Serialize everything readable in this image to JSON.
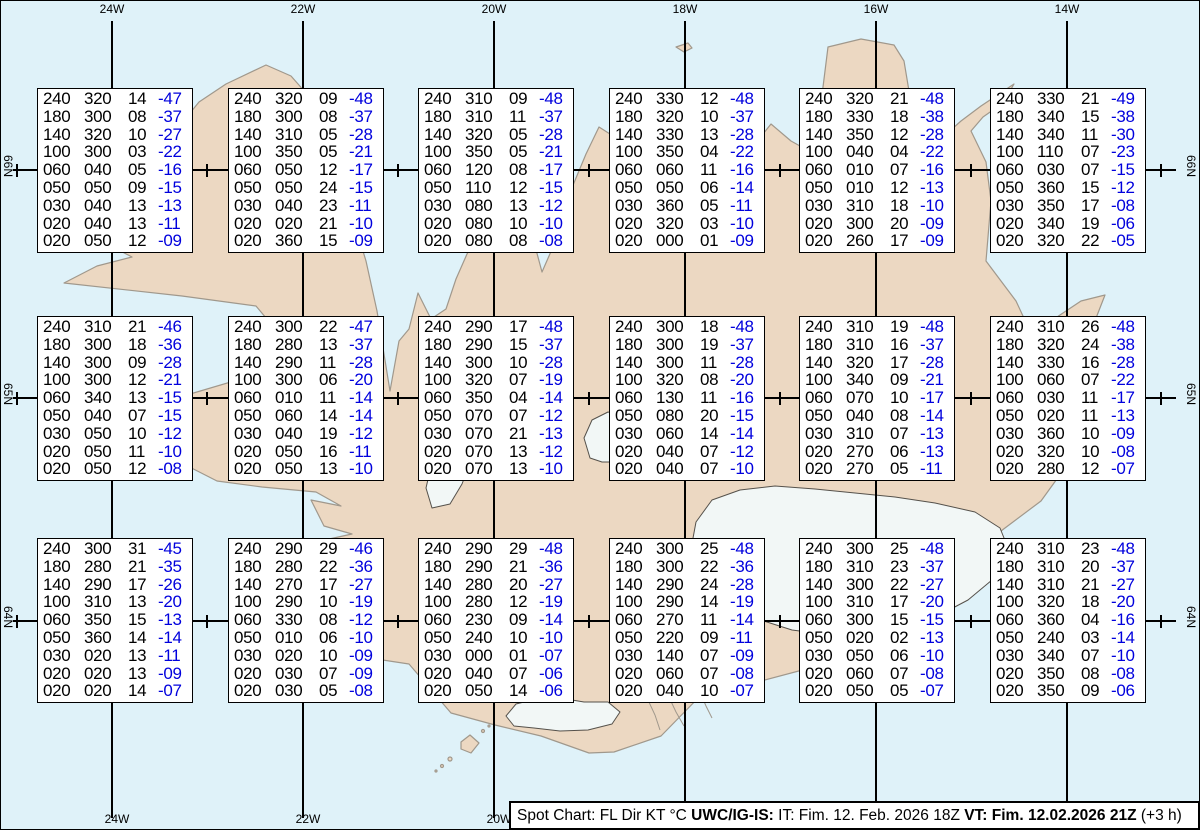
{
  "colors": {
    "ocean": "#dff2f9",
    "land": "#ecd8c2",
    "coast": "#a0988c",
    "glacier": "#f2f7f6",
    "glacier_outline": "#55514b",
    "graticule": "#000000",
    "box_bg": "#ffffff",
    "box_border": "#000000",
    "text_black": "#000000",
    "temp_blue": "#0000dd",
    "footer_bg": "#ffffff"
  },
  "graticule": {
    "meridians": [
      {
        "label": "24W",
        "x": 112
      },
      {
        "label": "22W",
        "x": 303
      },
      {
        "label": "20W",
        "x": 494
      },
      {
        "label": "18W",
        "x": 685
      },
      {
        "label": "16W",
        "x": 876
      },
      {
        "label": "14W",
        "x": 1067
      }
    ],
    "parallels": [
      {
        "label": "66N",
        "y": 170
      },
      {
        "label": "65N",
        "y": 398
      },
      {
        "label": "64N",
        "y": 621
      }
    ],
    "tick_xs": [
      17,
      207,
      398,
      589,
      780,
      971,
      1161
    ]
  },
  "spot_grid": {
    "col_x": [
      37,
      228,
      418,
      609,
      799,
      990
    ],
    "row_y": [
      88,
      316,
      538
    ],
    "box_w": 156,
    "box_h": 165,
    "column_meaning": [
      "FL",
      "Dir",
      "KT",
      "C"
    ]
  },
  "boxes": [
    {
      "id": "r1c1",
      "row": 0,
      "col": 0,
      "rows": [
        [
          "240",
          "320",
          "14",
          "-47"
        ],
        [
          "180",
          "300",
          "08",
          "-37"
        ],
        [
          "140",
          "320",
          "10",
          "-27"
        ],
        [
          "100",
          "300",
          "03",
          "-22"
        ],
        [
          "060",
          "040",
          "05",
          "-16"
        ],
        [
          "050",
          "050",
          "09",
          "-15"
        ],
        [
          "030",
          "040",
          "13",
          "-13"
        ],
        [
          "020",
          "040",
          "13",
          "-11"
        ],
        [
          "020",
          "050",
          "12",
          "-09"
        ]
      ]
    },
    {
      "id": "r1c2",
      "row": 0,
      "col": 1,
      "rows": [
        [
          "240",
          "320",
          "09",
          "-48"
        ],
        [
          "180",
          "300",
          "08",
          "-37"
        ],
        [
          "140",
          "310",
          "05",
          "-28"
        ],
        [
          "100",
          "350",
          "05",
          "-21"
        ],
        [
          "060",
          "050",
          "12",
          "-17"
        ],
        [
          "050",
          "050",
          "24",
          "-15"
        ],
        [
          "030",
          "040",
          "23",
          "-11"
        ],
        [
          "020",
          "020",
          "21",
          "-10"
        ],
        [
          "020",
          "360",
          "15",
          "-09"
        ]
      ]
    },
    {
      "id": "r1c3",
      "row": 0,
      "col": 2,
      "rows": [
        [
          "240",
          "310",
          "09",
          "-48"
        ],
        [
          "180",
          "310",
          "11",
          "-37"
        ],
        [
          "140",
          "320",
          "05",
          "-28"
        ],
        [
          "100",
          "350",
          "05",
          "-21"
        ],
        [
          "060",
          "120",
          "08",
          "-17"
        ],
        [
          "050",
          "110",
          "12",
          "-15"
        ],
        [
          "030",
          "080",
          "13",
          "-12"
        ],
        [
          "020",
          "080",
          "10",
          "-10"
        ],
        [
          "020",
          "080",
          "08",
          "-08"
        ]
      ]
    },
    {
      "id": "r1c4",
      "row": 0,
      "col": 3,
      "rows": [
        [
          "240",
          "330",
          "12",
          "-48"
        ],
        [
          "180",
          "320",
          "10",
          "-37"
        ],
        [
          "140",
          "330",
          "13",
          "-28"
        ],
        [
          "100",
          "350",
          "04",
          "-22"
        ],
        [
          "060",
          "060",
          "11",
          "-16"
        ],
        [
          "050",
          "050",
          "06",
          "-14"
        ],
        [
          "030",
          "360",
          "05",
          "-11"
        ],
        [
          "020",
          "320",
          "03",
          "-10"
        ],
        [
          "020",
          "000",
          "01",
          "-09"
        ]
      ]
    },
    {
      "id": "r1c5",
      "row": 0,
      "col": 4,
      "rows": [
        [
          "240",
          "320",
          "21",
          "-48"
        ],
        [
          "180",
          "330",
          "18",
          "-38"
        ],
        [
          "140",
          "350",
          "12",
          "-28"
        ],
        [
          "100",
          "040",
          "04",
          "-22"
        ],
        [
          "060",
          "010",
          "07",
          "-16"
        ],
        [
          "050",
          "010",
          "12",
          "-13"
        ],
        [
          "030",
          "310",
          "18",
          "-10"
        ],
        [
          "020",
          "300",
          "20",
          "-09"
        ],
        [
          "020",
          "260",
          "17",
          "-09"
        ]
      ]
    },
    {
      "id": "r1c6",
      "row": 0,
      "col": 5,
      "rows": [
        [
          "240",
          "330",
          "21",
          "-49"
        ],
        [
          "180",
          "340",
          "15",
          "-38"
        ],
        [
          "140",
          "340",
          "11",
          "-30"
        ],
        [
          "100",
          "110",
          "07",
          "-23"
        ],
        [
          "060",
          "030",
          "07",
          "-15"
        ],
        [
          "050",
          "360",
          "15",
          "-12"
        ],
        [
          "030",
          "350",
          "17",
          "-08"
        ],
        [
          "020",
          "340",
          "19",
          "-06"
        ],
        [
          "020",
          "320",
          "22",
          "-05"
        ]
      ]
    },
    {
      "id": "r2c1",
      "row": 1,
      "col": 0,
      "rows": [
        [
          "240",
          "310",
          "21",
          "-46"
        ],
        [
          "180",
          "300",
          "18",
          "-36"
        ],
        [
          "140",
          "300",
          "09",
          "-28"
        ],
        [
          "100",
          "300",
          "12",
          "-21"
        ],
        [
          "060",
          "340",
          "13",
          "-15"
        ],
        [
          "050",
          "040",
          "07",
          "-15"
        ],
        [
          "030",
          "050",
          "10",
          "-12"
        ],
        [
          "020",
          "050",
          "11",
          "-10"
        ],
        [
          "020",
          "050",
          "12",
          "-08"
        ]
      ]
    },
    {
      "id": "r2c2",
      "row": 1,
      "col": 1,
      "rows": [
        [
          "240",
          "300",
          "22",
          "-47"
        ],
        [
          "180",
          "280",
          "13",
          "-37"
        ],
        [
          "140",
          "290",
          "11",
          "-28"
        ],
        [
          "100",
          "300",
          "06",
          "-20"
        ],
        [
          "060",
          "010",
          "11",
          "-14"
        ],
        [
          "050",
          "060",
          "14",
          "-14"
        ],
        [
          "030",
          "040",
          "19",
          "-12"
        ],
        [
          "020",
          "050",
          "16",
          "-11"
        ],
        [
          "020",
          "050",
          "13",
          "-10"
        ]
      ]
    },
    {
      "id": "r2c3",
      "row": 1,
      "col": 2,
      "rows": [
        [
          "240",
          "290",
          "17",
          "-48"
        ],
        [
          "180",
          "290",
          "15",
          "-37"
        ],
        [
          "140",
          "300",
          "10",
          "-28"
        ],
        [
          "100",
          "320",
          "07",
          "-19"
        ],
        [
          "060",
          "350",
          "04",
          "-14"
        ],
        [
          "050",
          "070",
          "07",
          "-12"
        ],
        [
          "030",
          "070",
          "21",
          "-13"
        ],
        [
          "020",
          "070",
          "13",
          "-12"
        ],
        [
          "020",
          "070",
          "13",
          "-10"
        ]
      ]
    },
    {
      "id": "r2c4",
      "row": 1,
      "col": 3,
      "rows": [
        [
          "240",
          "300",
          "18",
          "-48"
        ],
        [
          "180",
          "300",
          "19",
          "-37"
        ],
        [
          "140",
          "300",
          "11",
          "-28"
        ],
        [
          "100",
          "320",
          "08",
          "-20"
        ],
        [
          "060",
          "130",
          "11",
          "-16"
        ],
        [
          "050",
          "080",
          "20",
          "-15"
        ],
        [
          "030",
          "060",
          "14",
          "-14"
        ],
        [
          "020",
          "040",
          "07",
          "-12"
        ],
        [
          "020",
          "040",
          "07",
          "-10"
        ]
      ]
    },
    {
      "id": "r2c5",
      "row": 1,
      "col": 4,
      "rows": [
        [
          "240",
          "310",
          "19",
          "-48"
        ],
        [
          "180",
          "310",
          "16",
          "-37"
        ],
        [
          "140",
          "320",
          "17",
          "-28"
        ],
        [
          "100",
          "340",
          "09",
          "-21"
        ],
        [
          "060",
          "070",
          "10",
          "-17"
        ],
        [
          "050",
          "040",
          "08",
          "-14"
        ],
        [
          "030",
          "310",
          "07",
          "-13"
        ],
        [
          "020",
          "270",
          "06",
          "-13"
        ],
        [
          "020",
          "270",
          "05",
          "-11"
        ]
      ]
    },
    {
      "id": "r2c6",
      "row": 1,
      "col": 5,
      "rows": [
        [
          "240",
          "310",
          "26",
          "-48"
        ],
        [
          "180",
          "320",
          "24",
          "-38"
        ],
        [
          "140",
          "330",
          "16",
          "-28"
        ],
        [
          "100",
          "060",
          "07",
          "-22"
        ],
        [
          "060",
          "030",
          "11",
          "-17"
        ],
        [
          "050",
          "020",
          "11",
          "-13"
        ],
        [
          "030",
          "360",
          "10",
          "-09"
        ],
        [
          "020",
          "320",
          "10",
          "-08"
        ],
        [
          "020",
          "280",
          "12",
          "-07"
        ]
      ]
    },
    {
      "id": "r3c1",
      "row": 2,
      "col": 0,
      "rows": [
        [
          "240",
          "300",
          "31",
          "-45"
        ],
        [
          "180",
          "280",
          "21",
          "-35"
        ],
        [
          "140",
          "290",
          "17",
          "-26"
        ],
        [
          "100",
          "310",
          "13",
          "-20"
        ],
        [
          "060",
          "350",
          "15",
          "-13"
        ],
        [
          "050",
          "360",
          "14",
          "-14"
        ],
        [
          "030",
          "020",
          "13",
          "-11"
        ],
        [
          "020",
          "020",
          "13",
          "-09"
        ],
        [
          "020",
          "020",
          "14",
          "-07"
        ]
      ]
    },
    {
      "id": "r3c2",
      "row": 2,
      "col": 1,
      "rows": [
        [
          "240",
          "290",
          "29",
          "-46"
        ],
        [
          "180",
          "280",
          "22",
          "-36"
        ],
        [
          "140",
          "270",
          "17",
          "-27"
        ],
        [
          "100",
          "290",
          "10",
          "-19"
        ],
        [
          "060",
          "330",
          "08",
          "-12"
        ],
        [
          "050",
          "010",
          "06",
          "-10"
        ],
        [
          "030",
          "020",
          "10",
          "-09"
        ],
        [
          "020",
          "030",
          "07",
          "-09"
        ],
        [
          "020",
          "030",
          "05",
          "-08"
        ]
      ]
    },
    {
      "id": "r3c3",
      "row": 2,
      "col": 2,
      "rows": [
        [
          "240",
          "290",
          "29",
          "-48"
        ],
        [
          "180",
          "290",
          "21",
          "-36"
        ],
        [
          "140",
          "280",
          "20",
          "-27"
        ],
        [
          "100",
          "280",
          "12",
          "-19"
        ],
        [
          "060",
          "230",
          "09",
          "-14"
        ],
        [
          "050",
          "240",
          "10",
          "-10"
        ],
        [
          "030",
          "000",
          "01",
          "-07"
        ],
        [
          "020",
          "040",
          "07",
          "-06"
        ],
        [
          "020",
          "050",
          "14",
          "-06"
        ]
      ]
    },
    {
      "id": "r3c4",
      "row": 2,
      "col": 3,
      "rows": [
        [
          "240",
          "300",
          "25",
          "-48"
        ],
        [
          "180",
          "300",
          "22",
          "-36"
        ],
        [
          "140",
          "290",
          "24",
          "-28"
        ],
        [
          "100",
          "290",
          "14",
          "-19"
        ],
        [
          "060",
          "270",
          "11",
          "-14"
        ],
        [
          "050",
          "220",
          "09",
          "-11"
        ],
        [
          "030",
          "140",
          "07",
          "-09"
        ],
        [
          "020",
          "060",
          "07",
          "-08"
        ],
        [
          "020",
          "040",
          "10",
          "-07"
        ]
      ]
    },
    {
      "id": "r3c5",
      "row": 2,
      "col": 4,
      "rows": [
        [
          "240",
          "300",
          "25",
          "-48"
        ],
        [
          "180",
          "310",
          "23",
          "-37"
        ],
        [
          "140",
          "300",
          "22",
          "-27"
        ],
        [
          "100",
          "310",
          "17",
          "-20"
        ],
        [
          "060",
          "300",
          "15",
          "-15"
        ],
        [
          "050",
          "020",
          "02",
          "-13"
        ],
        [
          "030",
          "050",
          "06",
          "-10"
        ],
        [
          "020",
          "060",
          "07",
          "-08"
        ],
        [
          "020",
          "050",
          "05",
          "-07"
        ]
      ]
    },
    {
      "id": "r3c6",
      "row": 2,
      "col": 5,
      "rows": [
        [
          "240",
          "310",
          "23",
          "-48"
        ],
        [
          "180",
          "310",
          "20",
          "-37"
        ],
        [
          "140",
          "310",
          "21",
          "-27"
        ],
        [
          "100",
          "320",
          "18",
          "-20"
        ],
        [
          "060",
          "360",
          "04",
          "-16"
        ],
        [
          "050",
          "240",
          "03",
          "-14"
        ],
        [
          "030",
          "340",
          "07",
          "-10"
        ],
        [
          "020",
          "350",
          "08",
          "-08"
        ],
        [
          "020",
          "350",
          "09",
          "-06"
        ]
      ]
    }
  ],
  "footer": {
    "segments": [
      {
        "text": "Spot Chart: FL Dir KT °C ",
        "bold": false
      },
      {
        "text": "UWC/IG-IS:",
        "bold": true
      },
      {
        "text": " IT: Fim. 12. Feb. 2026 18Z ",
        "bold": false
      },
      {
        "text": "VT: Fim. 12.02.2026 21Z",
        "bold": true
      },
      {
        "text": " (+3 h)",
        "bold": false
      }
    ]
  }
}
